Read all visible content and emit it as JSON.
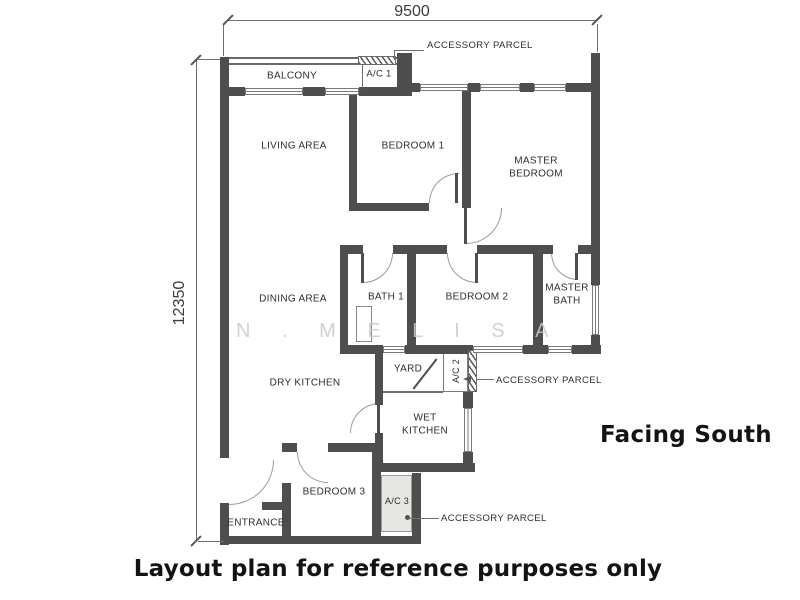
{
  "plan": {
    "dim_top": "9500",
    "dim_left": "12350",
    "rooms": {
      "balcony": "BALCONY",
      "ac1": "A/C 1",
      "living_area": "LIVING AREA",
      "bedroom1": "BEDROOM 1",
      "master_bedroom": "MASTER BEDROOM",
      "dining_area": "DINING AREA",
      "bath1": "BATH 1",
      "bedroom2": "BEDROOM 2",
      "master_bath": "MASTER BATH",
      "dry_kitchen": "DRY KITCHEN",
      "yard": "YARD",
      "ac2": "A/C 2",
      "wet_kitchen": "WET KITCHEN",
      "bedroom3": "BEDROOM 3",
      "ac3": "A/C 3",
      "entrance": "ENTRANCE"
    },
    "callouts": {
      "accessory_parcel_top": "ACCESSORY PARCEL",
      "accessory_parcel_middle": "ACCESSORY PARCEL",
      "accessory_parcel_bottom": "ACCESSORY PARCEL"
    }
  },
  "annotations": {
    "facing_direction": "Facing South",
    "caption": "Layout plan for reference purposes only",
    "watermark": "N . M E L I S A"
  },
  "colors": {
    "wall": "#4e4e4e",
    "ac_shaded_fill": "#e6e6e3",
    "watermark_gray": "#c9c9c9",
    "label_text": "#2e2e2e",
    "heading_text": "#131313"
  }
}
